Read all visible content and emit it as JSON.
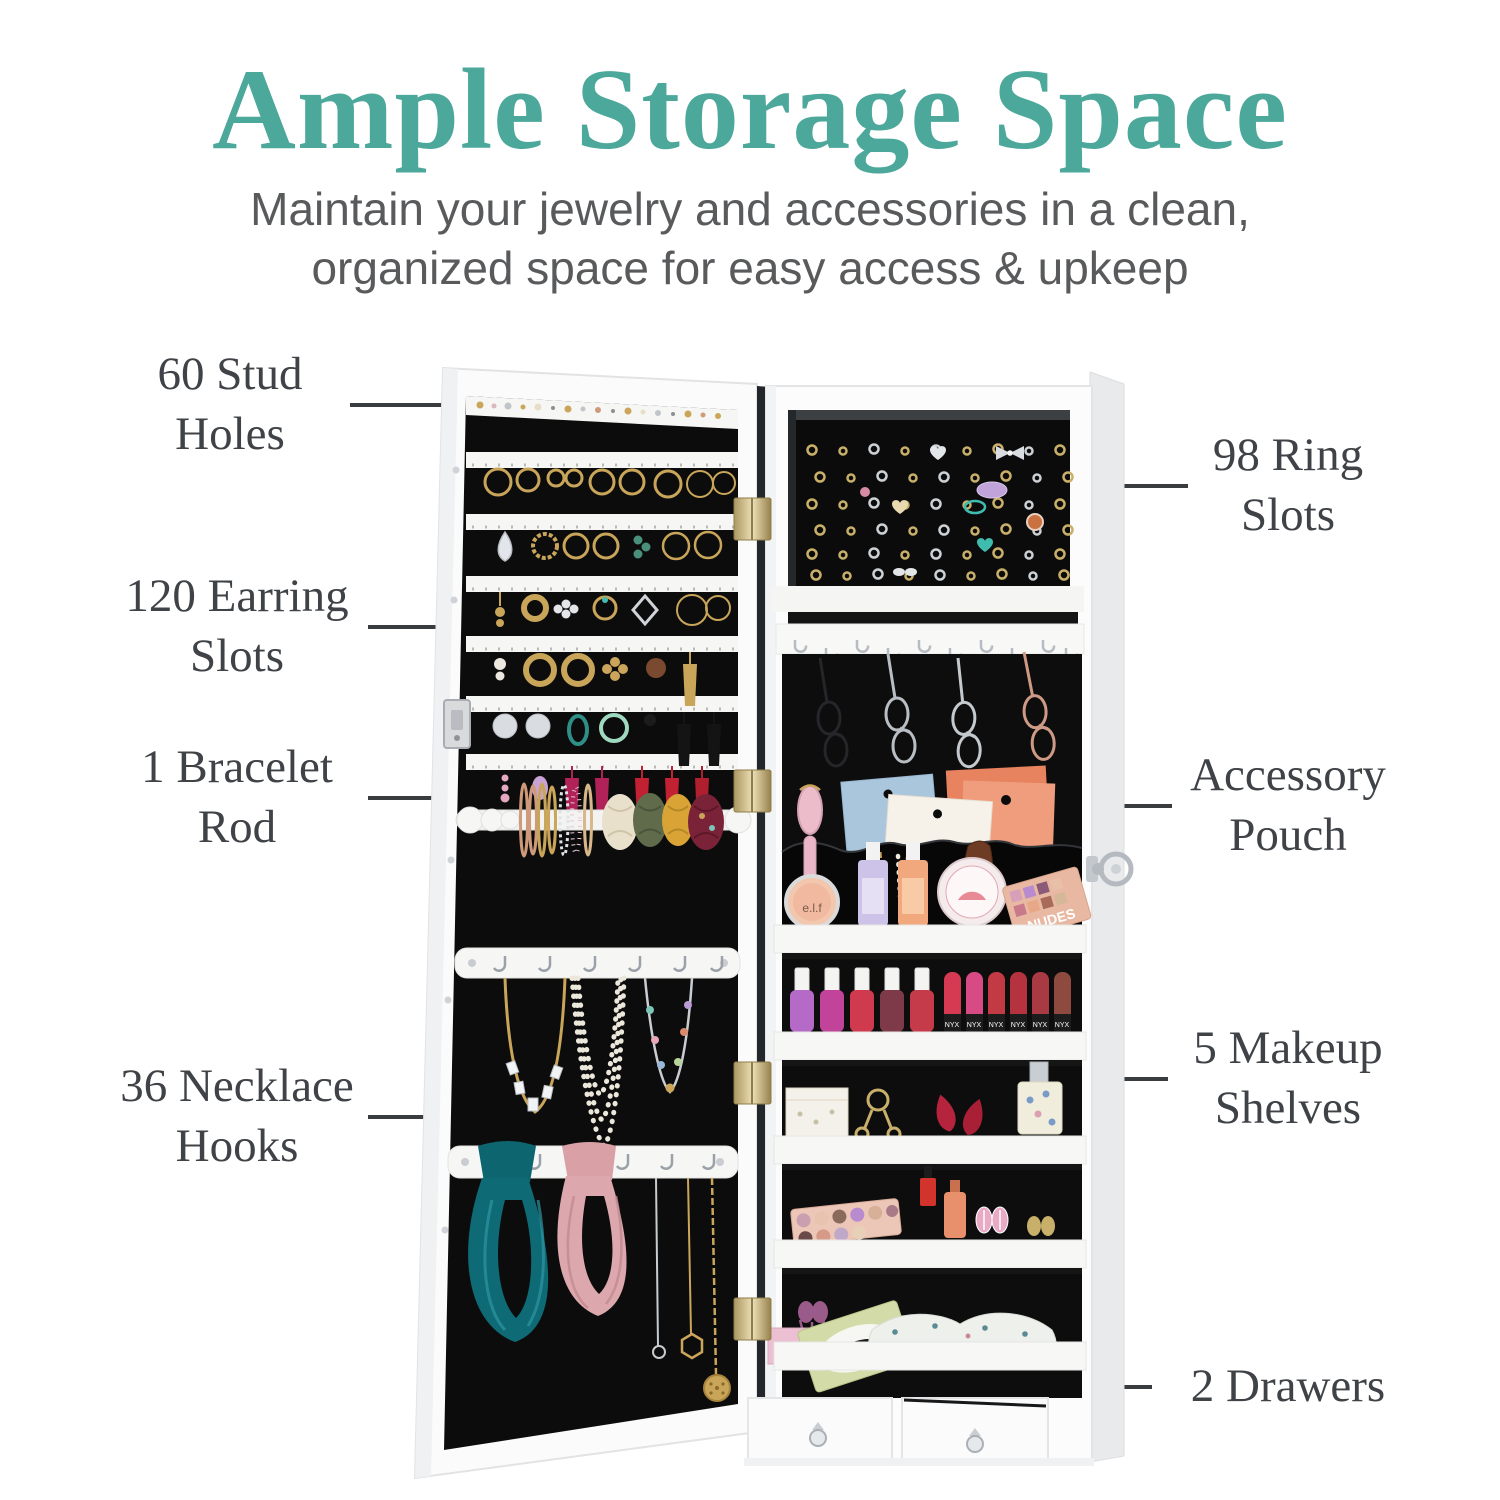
{
  "header": {
    "title": "Ample Storage Space",
    "subtitle": "Maintain your jewelry and accessories in a clean,\norganized space for easy access & upkeep"
  },
  "callouts": {
    "items": [
      {
        "id": "stud-holes",
        "label": "60 Stud\nHoles",
        "side": "left"
      },
      {
        "id": "earring-slots",
        "label": "120 Earring\nSlots",
        "side": "left"
      },
      {
        "id": "bracelet-rod",
        "label": "1 Bracelet\nRod",
        "side": "left"
      },
      {
        "id": "necklace-hooks",
        "label": "36 Necklace\nHooks",
        "side": "left"
      },
      {
        "id": "ring-slots",
        "label": "98 Ring\nSlots",
        "side": "right"
      },
      {
        "id": "accessory-pouch",
        "label": "Accessory\nPouch",
        "side": "right"
      },
      {
        "id": "makeup-shelves",
        "label": "5 Makeup\nShelves",
        "side": "right"
      },
      {
        "id": "drawers",
        "label": "2 Drawers",
        "side": "right"
      }
    ]
  },
  "product_labels": {
    "blush": "e.l.f",
    "palette": "NUDES",
    "lip_crayon": "NYX",
    "card": "avatāra"
  },
  "colors": {
    "title": "#4BA89A",
    "label_text": "#3F4347",
    "subtitle_text": "#595A5C",
    "leader": "#3A3D40",
    "felt": "#0C0C0C",
    "cabinet_white": "#FBFBFC"
  }
}
